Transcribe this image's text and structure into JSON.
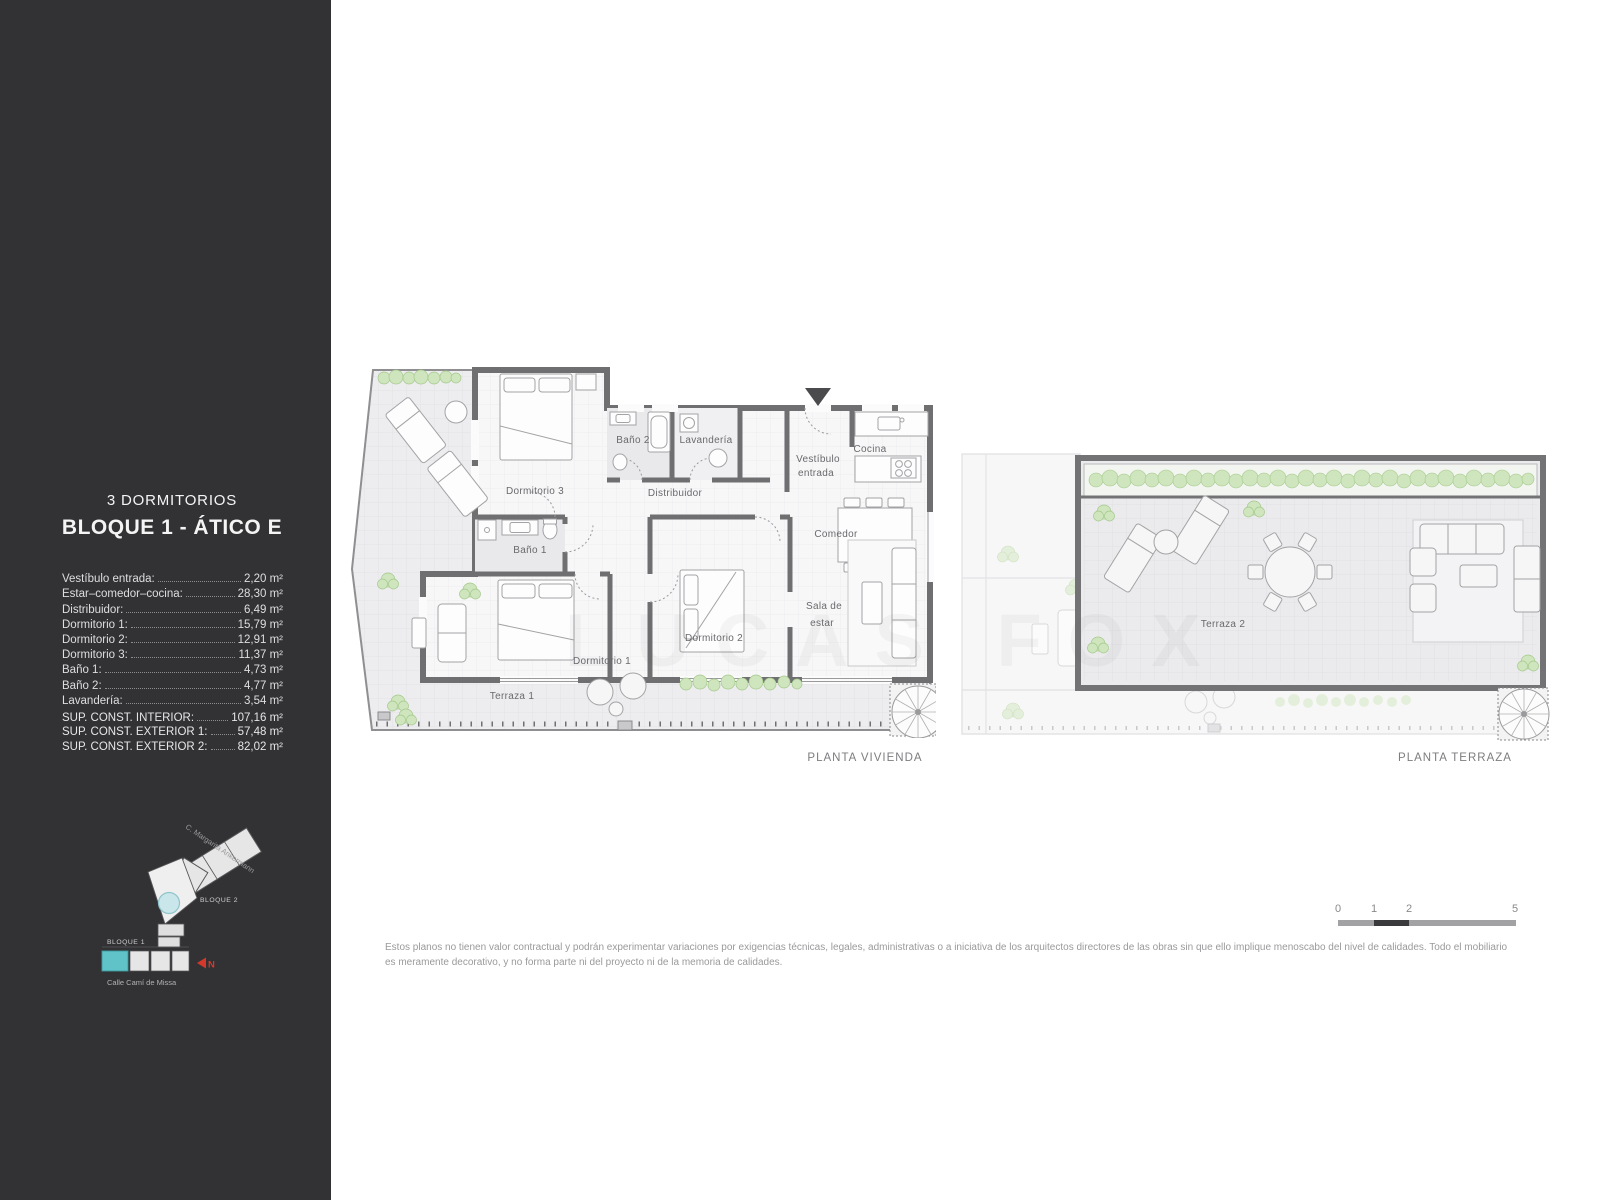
{
  "sidebar": {
    "title_line1": "3 DORMITORIOS",
    "title_line2": "BLOQUE 1 - ÁTICO E",
    "areas": [
      {
        "label": "Vestíbulo entrada:",
        "value": "2,20 m²"
      },
      {
        "label": "Estar–comedor–cocina:",
        "value": "28,30 m²"
      },
      {
        "label": "Distribuidor:",
        "value": "6,49 m²"
      },
      {
        "label": "Dormitorio 1:",
        "value": "15,79 m²"
      },
      {
        "label": "Dormitorio 2:",
        "value": "12,91 m²"
      },
      {
        "label": "Dormitorio 3:",
        "value": "11,37 m²"
      },
      {
        "label": "Baño 1:",
        "value": "4,73 m²"
      },
      {
        "label": "Baño 2:",
        "value": "4,77 m²"
      },
      {
        "label": "Lavandería:",
        "value": "3,54 m²"
      }
    ],
    "totals": [
      {
        "label": "SUP. CONST. INTERIOR:",
        "value": "107,16 m²"
      },
      {
        "label": "SUP. CONST. EXTERIOR 1:",
        "value": "57,48 m²"
      },
      {
        "label": "SUP. CONST. EXTERIOR 2:",
        "value": "82,02 m²"
      }
    ],
    "site_plan": {
      "street_top": "C. Margarita Ankermann",
      "street_bottom": "Calle Camí de Missa",
      "bloque1": "BLOQUE 1",
      "bloque2": "BLOQUE 2",
      "north": "N"
    }
  },
  "plans": {
    "vivienda": {
      "caption": "PLANTA VIVIENDA",
      "rooms": {
        "dormitorio3": "Dormitorio 3",
        "bano2": "Baño 2",
        "lavanderia": "Lavandería",
        "vestibulo_l1": "Vestíbulo",
        "vestibulo_l2": "entrada",
        "cocina": "Cocina",
        "distribuidor": "Distribuidor",
        "comedor": "Comedor",
        "bano1": "Baño 1",
        "dormitorio1": "Dormitorio 1",
        "dormitorio2": "Dormitorio 2",
        "sala_l1": "Sala de",
        "sala_l2": "estar",
        "terraza1": "Terraza 1"
      }
    },
    "terraza": {
      "caption": "PLANTA TERRAZA",
      "rooms": {
        "terraza2": "Terraza 2"
      }
    }
  },
  "scale_bar": {
    "ticks": [
      "0",
      "1",
      "2",
      "5"
    ]
  },
  "watermark": "LUCAS FOX",
  "disclaimer": "Estos planos no tienen valor contractual y podrán experimentar variaciones por exigencias técnicas, legales, administrativas o a iniciativa de los arquitectos directores de las obras sin que ello implique menoscabo del nivel de calidades. Todo el mobiliario es meramente decorativo, y no forma parte ni del proyecto ni de la memoria de calidades.",
  "colors": {
    "sidebar_bg": "#323234",
    "wall_gray": "#6f6f71",
    "accent_teal": "#5fc3c8",
    "north_red": "#d6382c",
    "plant_green": "#cfe5bd"
  }
}
